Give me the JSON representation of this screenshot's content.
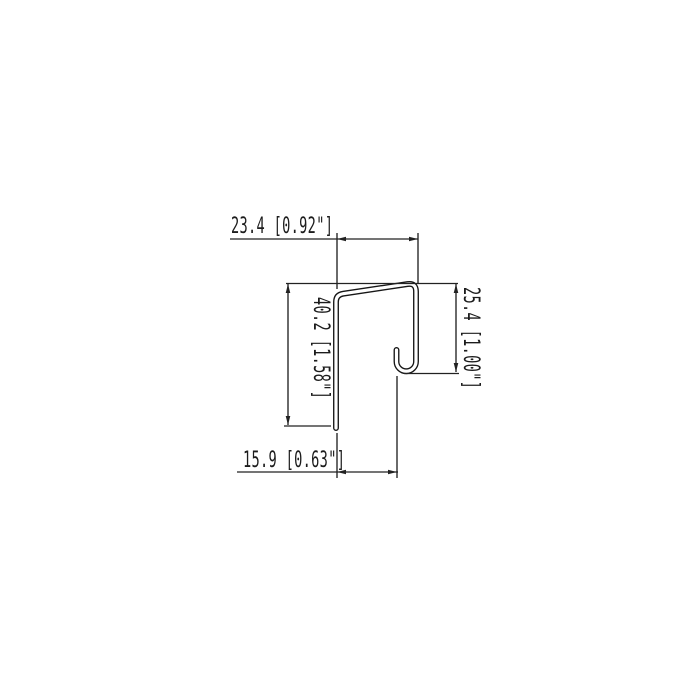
{
  "drawing": {
    "background_color": "#ffffff",
    "line_color": "#1c1c1c",
    "dimensions": {
      "top_width": {
        "label": "23.4 [0.92\"]",
        "value_mm": 23.4,
        "value_inch": 0.92
      },
      "left_height": {
        "label": "40.2 [1.58\"]",
        "value_mm": 40.2,
        "value_inch": 1.58
      },
      "right_depth": {
        "label": "25.4 [1.00\"]",
        "value_mm": 25.4,
        "value_inch": 1.0
      },
      "bottom_offset": {
        "label": "15.9 [0.63\"]",
        "value_mm": 15.9,
        "value_inch": 0.63
      }
    }
  }
}
